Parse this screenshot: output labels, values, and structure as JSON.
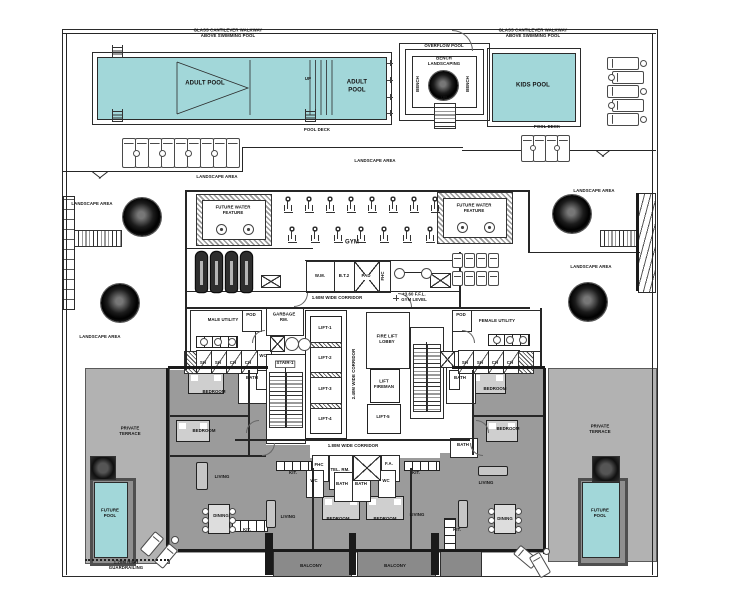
{
  "drawing": {
    "type": "architectural-floor-plan",
    "colors": {
      "pool_water": "#a2d7d9",
      "terrace": "#b2b2b2",
      "unit_interior": "#9b9b9b",
      "balcony": "#8a8a8a",
      "linework": "#2a2a2a"
    },
    "pool_deck": {
      "walkway_note": "GLASS CANTILEVER WALKWAY\nABOVE SWIMMING POOL",
      "adult_pool": "ADULT POOL",
      "up": "UP",
      "overflow_pool": "OVERFLOW POOL",
      "bench_landscaping": "BENCH\nLANDSCAPING",
      "bench": "BENCH",
      "kids_pool": "KIDS POOL",
      "pool_deck": "POOL DECK",
      "landscape_area": "LANDSCAPE AREA"
    },
    "gym": {
      "gym": "GYM",
      "future_water_feature": "FUTURE WATER\nFEATURE",
      "wm": "W.M.",
      "bt2": "B.T.2",
      "pad": "PAD",
      "fhc": "FHC",
      "corridor": "1.60M WIDE CORRIDOR",
      "ffl_note": "+3.60 F.F.L.\nGYM LEVEL"
    },
    "core": {
      "garbage_rm": "GARBAGE\nRM.",
      "stair1": "STAIR-1",
      "lift1": "LIFT-1",
      "lift2": "LIFT-2",
      "lift3": "LIFT-3",
      "lift4": "LIFT-4",
      "fire_lift_lobby": "FIRE LIFT\nLOBBY",
      "lift_fireman": "LIFT\nFIREMAN",
      "lift5": "LIFT-5",
      "corridor_v": "2.40M WIDE CORRIDOR",
      "male_utility": "MALE UTILITY",
      "female_utility": "FEMALE UTILITY",
      "pod": "POD",
      "wc": "WC",
      "bath": "BATH",
      "lockers": [
        "SH",
        "SH",
        "CH",
        "CH"
      ]
    },
    "residences": {
      "corridor": "1.80M WIDE CORRIDOR",
      "fhc": "FHC",
      "tel_rm": "TEL. RM.",
      "fa": "F.A.",
      "wc": "WC",
      "bath": "BATH",
      "bedroom": "BEDROOM",
      "living": "LIVING",
      "dining": "DINING",
      "kitchen": "KIT.",
      "balcony": "BALCONY",
      "private_terrace": "PRIVATE\nTERRACE",
      "future_pool": "FUTURE\nPOOL",
      "guardrail_note": "1.20M HIGH\nGUARDRAILING"
    }
  }
}
